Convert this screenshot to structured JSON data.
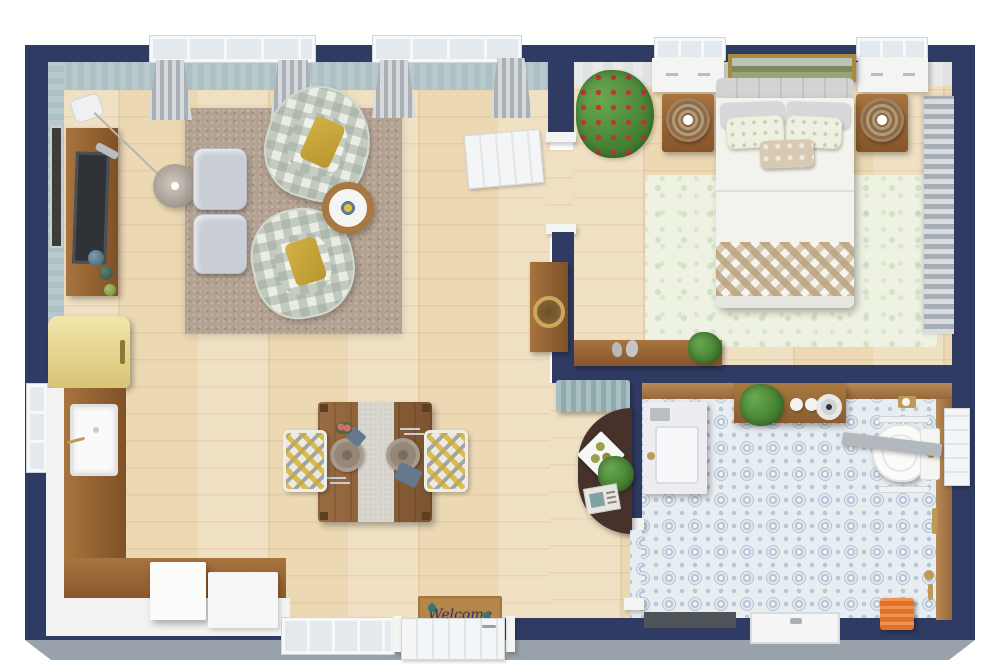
{
  "scene": {
    "type": "3d-floor-plan-top-view",
    "description": "One-bedroom apartment 3D floor plan: living room with kitchen and dining area, bedroom, bathroom"
  },
  "doormat": {
    "text": "Welcome"
  },
  "palette": {
    "wall": "#2f3b63",
    "skirt": "#99a2ab",
    "floor-wood": "#ecd9b4",
    "rug-living": "#b3a291",
    "rug-bedroom": "#eef2e2",
    "tile-blue": "#b7c7d8",
    "counter-wood": "#9a6c42",
    "cabinet-white": "#f4f5f3",
    "fridge-yellow": "#e9d98f",
    "pillow-mustard": "#c9a93d",
    "accent-orange": "#e0722c",
    "gold": "#bd9a58",
    "plant-green": "#4f8c3a",
    "flower-red": "#c23434",
    "teal-cabinet": "#9db9bd",
    "dark-table": "#46322b",
    "mat": "#b5854a"
  },
  "rooms": [
    {
      "name": "Living room",
      "furniture": [
        "tv-console",
        "tv",
        "remote",
        "wall-art",
        "arc-floor-lamp",
        "glass-globe-shade",
        "area-rug",
        "ottoman",
        "ottoman",
        "plaid-armchair",
        "plaid-armchair",
        "mustard-pillow",
        "round-side-table",
        "console-table",
        "woven-tray",
        "window-curtains"
      ]
    },
    {
      "name": "Kitchen / dining",
      "furniture": [
        "retro-fridge",
        "farmhouse-sink",
        "l-shaped-counter",
        "white-island",
        "dining-table",
        "table-runner",
        "dinner-plates",
        "ikat-side-chair",
        "ikat-side-chair",
        "welcome-doormat",
        "front-door",
        "window"
      ]
    },
    {
      "name": "Bedroom",
      "furniture": [
        "double-bed",
        "tufted-headboard",
        "gray-pillows",
        "floral-pillows",
        "lumbar-pillow",
        "gingham-throw",
        "floral-rug",
        "nightstand",
        "nightstand",
        "rattan-lamp",
        "rattan-lamp",
        "window-dresser",
        "window-dresser",
        "landscape-painting",
        "flowering-plant",
        "console-with-bird-figurines",
        "striped-curtains"
      ]
    },
    {
      "name": "Bathroom",
      "furniture": [
        "vanity-sink",
        "gold-faucet",
        "wall-shelf",
        "potted-plant",
        "soap-rounds",
        "vessel-bowl",
        "toilet",
        "grab-bars",
        "glass-partition",
        "towel-bar",
        "shower-valve",
        "orange-slat-stool",
        "shower-tray",
        "patterned-tile-floor",
        "side-door"
      ]
    },
    {
      "name": "Hall nook",
      "furniture": [
        "teal-striped-cabinet",
        "demilune-table",
        "napkin-stack",
        "magazine",
        "potted-plant"
      ]
    }
  ]
}
